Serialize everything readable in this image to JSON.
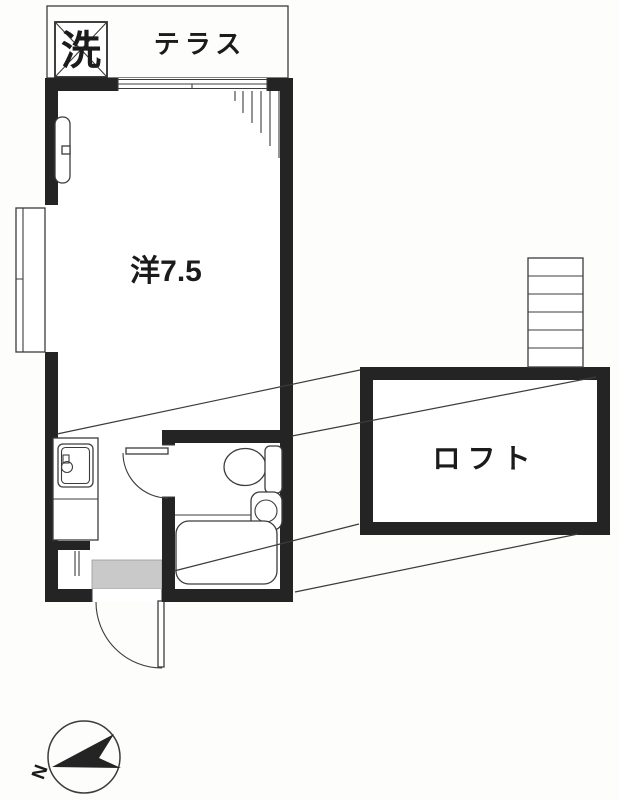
{
  "labels": {
    "washer": "洗",
    "terrace": "テラス",
    "main_room": "洋7.5",
    "loft": "ロフト",
    "compass_north": "N"
  },
  "colors": {
    "wall": "#242424",
    "line": "#3c3c3c",
    "entry_mat_fill": "#c9c9c9",
    "paper": "#fdfdfc"
  }
}
